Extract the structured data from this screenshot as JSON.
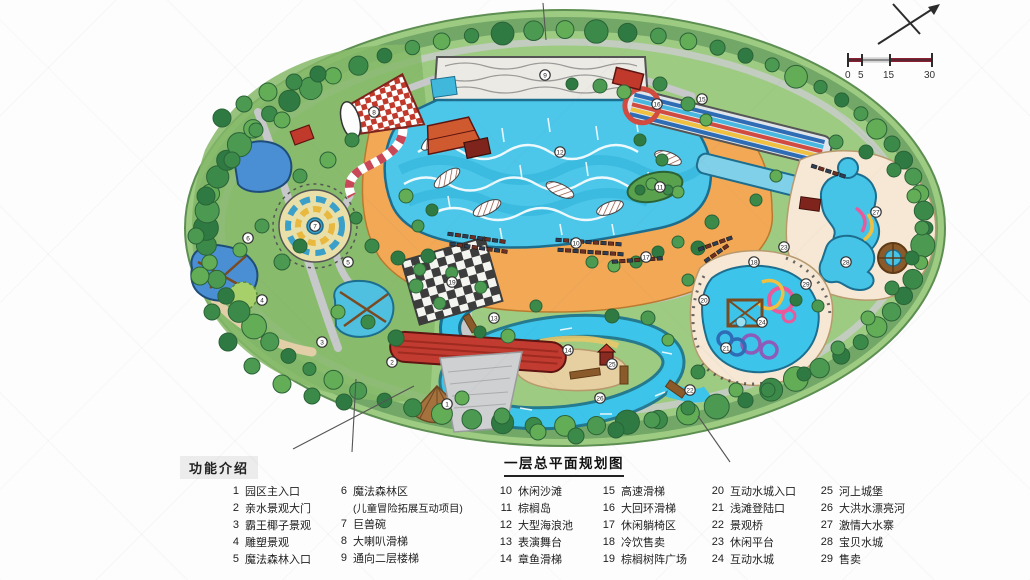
{
  "title": "一层总平面规划图",
  "legend": {
    "heading": "功能介绍",
    "columns": [
      {
        "items": [
          {
            "n": "1",
            "label": "园区主入口"
          },
          {
            "n": "2",
            "label": "亲水景观大门"
          },
          {
            "n": "3",
            "label": "霸王椰子景观"
          },
          {
            "n": "4",
            "label": "雕塑景观"
          },
          {
            "n": "5",
            "label": "魔法森林入口"
          }
        ]
      },
      {
        "items": [
          {
            "n": "6",
            "label": "魔法森林区"
          },
          {
            "n": "",
            "label": "(儿童冒险拓展互动项目)"
          },
          {
            "n": "7",
            "label": "巨兽碗"
          },
          {
            "n": "8",
            "label": "大喇叭滑梯"
          },
          {
            "n": "9",
            "label": "通向二层楼梯"
          }
        ]
      },
      {
        "items": [
          {
            "n": "10",
            "label": "休闲沙滩"
          },
          {
            "n": "11",
            "label": "棕榈岛"
          },
          {
            "n": "12",
            "label": "大型海浪池"
          },
          {
            "n": "13",
            "label": "表演舞台"
          },
          {
            "n": "14",
            "label": "章鱼滑梯"
          }
        ]
      },
      {
        "items": [
          {
            "n": "15",
            "label": "高速滑梯"
          },
          {
            "n": "16",
            "label": "大回环滑梯"
          },
          {
            "n": "17",
            "label": "休闲躺椅区"
          },
          {
            "n": "18",
            "label": "冷饮售卖"
          },
          {
            "n": "19",
            "label": "棕榈树阵广场"
          }
        ]
      },
      {
        "items": [
          {
            "n": "20",
            "label": "互动水城入口"
          },
          {
            "n": "21",
            "label": "浅滩登陆口"
          },
          {
            "n": "22",
            "label": "景观桥"
          },
          {
            "n": "23",
            "label": "休闲平台"
          },
          {
            "n": "24",
            "label": "互动水城"
          }
        ]
      },
      {
        "items": [
          {
            "n": "25",
            "label": "河上城堡"
          },
          {
            "n": "26",
            "label": "大洪水漂亮河"
          },
          {
            "n": "27",
            "label": "激情大水寨"
          },
          {
            "n": "28",
            "label": "宝贝水城"
          },
          {
            "n": "29",
            "label": "售卖"
          }
        ]
      }
    ]
  },
  "scalebar": {
    "ticks": [
      "0",
      "5",
      "15",
      "30"
    ]
  },
  "colors": {
    "water": "#45c6e8",
    "deep_water": "#2db0d8",
    "pool_blue": "#4a8fd4",
    "beach": "#f2a855",
    "deck_cream": "#f6e8d4",
    "tree_dark": "#2f7a42",
    "tree_mid": "#4c9a52",
    "tree_light": "#63ad57",
    "path_gray": "#c7c8ca",
    "roof_red": "#c23b30",
    "scale_red": "#8b2035",
    "slide_pink": "#e85a9b",
    "slide_yellow": "#f0c040",
    "slide_purple": "#8e5bb8",
    "slide_blue": "#2e6db5"
  },
  "map": {
    "markers": [
      {
        "n": "1",
        "x": 447,
        "y": 404
      },
      {
        "n": "2",
        "x": 392,
        "y": 362
      },
      {
        "n": "3",
        "x": 322,
        "y": 342
      },
      {
        "n": "4",
        "x": 262,
        "y": 300
      },
      {
        "n": "5",
        "x": 348,
        "y": 262
      },
      {
        "n": "6",
        "x": 248,
        "y": 238
      },
      {
        "n": "7",
        "x": 315,
        "y": 226
      },
      {
        "n": "8",
        "x": 374,
        "y": 112
      },
      {
        "n": "9",
        "x": 545,
        "y": 75
      },
      {
        "n": "10",
        "x": 576,
        "y": 243
      },
      {
        "n": "11",
        "x": 660,
        "y": 187
      },
      {
        "n": "12",
        "x": 560,
        "y": 152
      },
      {
        "n": "13",
        "x": 494,
        "y": 318
      },
      {
        "n": "14",
        "x": 568,
        "y": 350
      },
      {
        "n": "15",
        "x": 702,
        "y": 99
      },
      {
        "n": "16",
        "x": 657,
        "y": 104
      },
      {
        "n": "17",
        "x": 646,
        "y": 257
      },
      {
        "n": "18",
        "x": 754,
        "y": 262
      },
      {
        "n": "19",
        "x": 452,
        "y": 282
      },
      {
        "n": "20",
        "x": 704,
        "y": 300
      },
      {
        "n": "21",
        "x": 726,
        "y": 348
      },
      {
        "n": "22",
        "x": 690,
        "y": 390
      },
      {
        "n": "23",
        "x": 784,
        "y": 247
      },
      {
        "n": "24",
        "x": 762,
        "y": 322
      },
      {
        "n": "25",
        "x": 612,
        "y": 364
      },
      {
        "n": "26",
        "x": 600,
        "y": 398
      },
      {
        "n": "27",
        "x": 876,
        "y": 212
      },
      {
        "n": "28",
        "x": 846,
        "y": 262
      },
      {
        "n": "29",
        "x": 806,
        "y": 284
      }
    ]
  }
}
